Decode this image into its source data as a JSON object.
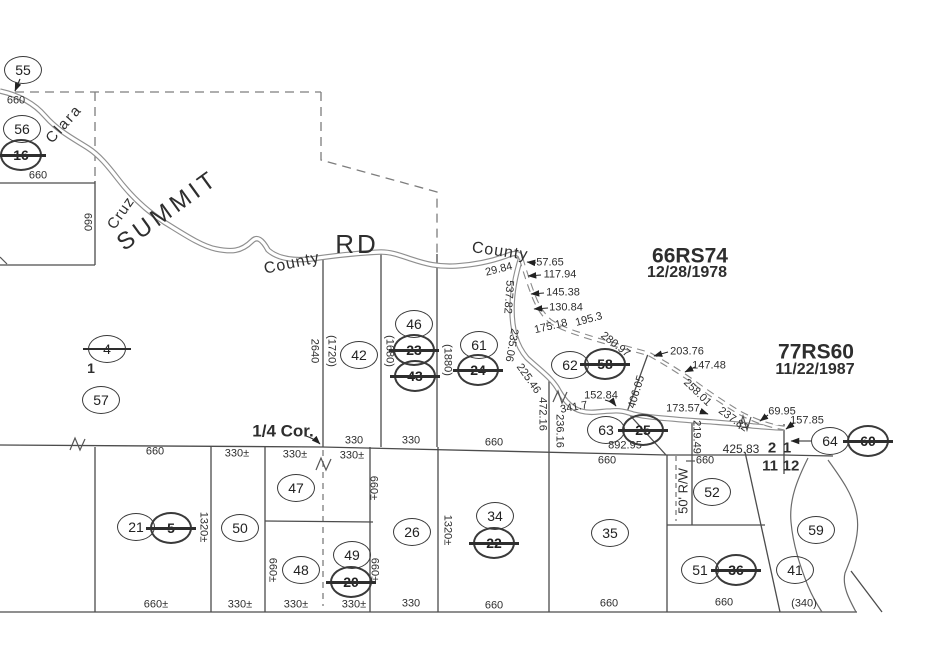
{
  "canvas": {
    "width": 950,
    "height": 650,
    "background": "#ffffff",
    "ink": "#2e2e2e"
  },
  "road": {
    "full_name": "Summit Rd (Santa Clara / Santa Cruz County line)"
  },
  "labels": [
    {
      "t": "Clara",
      "x": 64,
      "y": 124,
      "r": -48,
      "s": 15,
      "ls": 2,
      "k": "road"
    },
    {
      "t": "Cruz",
      "x": 121,
      "y": 213,
      "r": -55,
      "s": 15,
      "ls": 1,
      "k": "road"
    },
    {
      "t": "SUMMIT",
      "x": 168,
      "y": 211,
      "r": -36,
      "s": 24,
      "ls": 4,
      "k": "road"
    },
    {
      "t": "County",
      "x": 292,
      "y": 264,
      "r": -12,
      "s": 16,
      "ls": 1,
      "k": "road"
    },
    {
      "t": "RD",
      "x": 357,
      "y": 244,
      "r": 0,
      "s": 26,
      "ls": 3,
      "k": "road"
    },
    {
      "t": "County",
      "x": 500,
      "y": 252,
      "r": 8,
      "s": 16,
      "ls": 1,
      "k": "road"
    },
    {
      "t": "66RS74",
      "x": 690,
      "y": 256,
      "r": 0,
      "s": 21,
      "k": "survey"
    },
    {
      "t": "12/28/1978",
      "x": 687,
      "y": 273,
      "r": 0,
      "s": 16,
      "k": "survey"
    },
    {
      "t": "77RS60",
      "x": 816,
      "y": 352,
      "r": 0,
      "s": 21,
      "k": "survey"
    },
    {
      "t": "11/22/1987",
      "x": 815,
      "y": 370,
      "r": 0,
      "s": 16,
      "k": "survey"
    },
    {
      "t": "1/4 Cor.",
      "x": 283,
      "y": 431,
      "r": 0,
      "s": 17,
      "k": "corner"
    },
    {
      "t": "1",
      "x": 91,
      "y": 368,
      "r": 0,
      "s": 14,
      "k": "lot"
    },
    {
      "t": "2",
      "x": 772,
      "y": 448,
      "r": 0,
      "s": 15,
      "k": "section"
    },
    {
      "t": "1",
      "x": 787,
      "y": 448,
      "r": 0,
      "s": 15,
      "k": "section"
    },
    {
      "t": "11",
      "x": 770,
      "y": 466,
      "r": 0,
      "s": 15,
      "k": "section"
    },
    {
      "t": "12",
      "x": 791,
      "y": 466,
      "r": 0,
      "s": 15,
      "k": "section"
    },
    {
      "t": "660",
      "x": 16,
      "y": 101
    },
    {
      "t": "660",
      "x": 38,
      "y": 176
    },
    {
      "t": "660",
      "x": 87,
      "y": 222,
      "r": 90
    },
    {
      "t": "29.84",
      "x": 499,
      "y": 270,
      "r": -14
    },
    {
      "t": "57.65",
      "x": 550,
      "y": 263
    },
    {
      "t": "117.94",
      "x": 560,
      "y": 275
    },
    {
      "t": "145.38",
      "x": 563,
      "y": 293
    },
    {
      "t": "130.84",
      "x": 566,
      "y": 308
    },
    {
      "t": "537.82",
      "x": 508,
      "y": 297,
      "r": 94
    },
    {
      "t": "175.18",
      "x": 551,
      "y": 327,
      "r": -13
    },
    {
      "t": "195.3",
      "x": 589,
      "y": 320,
      "r": -15
    },
    {
      "t": "280.97",
      "x": 615,
      "y": 345,
      "r": 38
    },
    {
      "t": "235.06",
      "x": 511,
      "y": 345,
      "r": 100
    },
    {
      "t": "225.46",
      "x": 528,
      "y": 379,
      "r": 55
    },
    {
      "t": "203.76",
      "x": 687,
      "y": 352
    },
    {
      "t": "147.48",
      "x": 709,
      "y": 366
    },
    {
      "t": "258.01",
      "x": 697,
      "y": 393,
      "r": 44
    },
    {
      "t": "237.82",
      "x": 733,
      "y": 420,
      "r": 36
    },
    {
      "t": "406.05",
      "x": 637,
      "y": 392,
      "r": -73
    },
    {
      "t": "152.84",
      "x": 601,
      "y": 396
    },
    {
      "t": "341.7",
      "x": 574,
      "y": 408,
      "r": -10
    },
    {
      "t": "173.57",
      "x": 683,
      "y": 409
    },
    {
      "t": "472.16",
      "x": 542,
      "y": 414,
      "r": 90
    },
    {
      "t": "236.16",
      "x": 559,
      "y": 431,
      "r": 90
    },
    {
      "t": "219.49",
      "x": 696,
      "y": 437,
      "r": 90
    },
    {
      "t": "69.95",
      "x": 782,
      "y": 412
    },
    {
      "t": "157.85",
      "x": 807,
      "y": 421
    },
    {
      "t": "425.83",
      "x": 741,
      "y": 449,
      "s": 12
    },
    {
      "t": "892.95",
      "x": 625,
      "y": 446
    },
    {
      "t": "2640",
      "x": 314,
      "y": 351,
      "r": 90
    },
    {
      "t": "(1720)",
      "x": 331,
      "y": 351,
      "r": 90
    },
    {
      "t": "(1680)",
      "x": 389,
      "y": 351,
      "r": 90
    },
    {
      "t": "(1880)",
      "x": 447,
      "y": 360,
      "r": 90
    },
    {
      "t": "330",
      "x": 354,
      "y": 441
    },
    {
      "t": "330",
      "x": 411,
      "y": 441
    },
    {
      "t": "660",
      "x": 494,
      "y": 443
    },
    {
      "t": "660",
      "x": 155,
      "y": 452
    },
    {
      "t": "330±",
      "x": 237,
      "y": 454
    },
    {
      "t": "330±",
      "x": 295,
      "y": 455
    },
    {
      "t": "330±",
      "x": 352,
      "y": 456
    },
    {
      "t": "660",
      "x": 607,
      "y": 461
    },
    {
      "t": "660",
      "x": 705,
      "y": 461
    },
    {
      "t": "50' R/W",
      "x": 683,
      "y": 491,
      "r": -90,
      "s": 13
    },
    {
      "t": "1320±",
      "x": 203,
      "y": 527,
      "r": 90
    },
    {
      "t": "1320±",
      "x": 447,
      "y": 530,
      "r": 90
    },
    {
      "t": "660±",
      "x": 373,
      "y": 488,
      "r": 90
    },
    {
      "t": "660±",
      "x": 272,
      "y": 570,
      "r": 90
    },
    {
      "t": "660±",
      "x": 374,
      "y": 570,
      "r": 90
    },
    {
      "t": "660±",
      "x": 156,
      "y": 605
    },
    {
      "t": "330±",
      "x": 240,
      "y": 605
    },
    {
      "t": "330±",
      "x": 296,
      "y": 605
    },
    {
      "t": "330±",
      "x": 354,
      "y": 605
    },
    {
      "t": "330",
      "x": 411,
      "y": 604
    },
    {
      "t": "660",
      "x": 494,
      "y": 606
    },
    {
      "t": "660",
      "x": 609,
      "y": 604
    },
    {
      "t": "660",
      "x": 724,
      "y": 603
    },
    {
      "t": "(340)",
      "x": 804,
      "y": 604
    }
  ],
  "parcels": [
    {
      "n": "55",
      "x": 23,
      "y": 70,
      "st": false,
      "hv": false
    },
    {
      "n": "56",
      "x": 22,
      "y": 129,
      "st": false,
      "hv": false
    },
    {
      "n": "16",
      "x": 21,
      "y": 155,
      "st": true,
      "hv": true
    },
    {
      "n": "4",
      "x": 107,
      "y": 349,
      "st": true,
      "hv": false
    },
    {
      "n": "57",
      "x": 101,
      "y": 400,
      "st": false,
      "hv": false
    },
    {
      "n": "42",
      "x": 359,
      "y": 355,
      "st": false,
      "hv": false
    },
    {
      "n": "46",
      "x": 414,
      "y": 324,
      "st": false,
      "hv": false
    },
    {
      "n": "23",
      "x": 414,
      "y": 350,
      "st": true,
      "hv": true
    },
    {
      "n": "43",
      "x": 415,
      "y": 376,
      "st": true,
      "hv": true
    },
    {
      "n": "61",
      "x": 479,
      "y": 345,
      "st": false,
      "hv": false
    },
    {
      "n": "24",
      "x": 478,
      "y": 370,
      "st": true,
      "hv": true
    },
    {
      "n": "62",
      "x": 570,
      "y": 365,
      "st": false,
      "hv": false
    },
    {
      "n": "58",
      "x": 605,
      "y": 364,
      "st": true,
      "hv": true
    },
    {
      "n": "63",
      "x": 606,
      "y": 430,
      "st": false,
      "hv": false
    },
    {
      "n": "25",
      "x": 643,
      "y": 430,
      "st": true,
      "hv": true
    },
    {
      "n": "64",
      "x": 830,
      "y": 441,
      "st": false,
      "hv": false
    },
    {
      "n": "60",
      "x": 868,
      "y": 441,
      "st": true,
      "hv": true
    },
    {
      "n": "47",
      "x": 296,
      "y": 488,
      "st": false,
      "hv": false
    },
    {
      "n": "50",
      "x": 240,
      "y": 528,
      "st": false,
      "hv": false
    },
    {
      "n": "21",
      "x": 136,
      "y": 527,
      "st": false,
      "hv": false
    },
    {
      "n": "5",
      "x": 171,
      "y": 528,
      "st": true,
      "hv": true
    },
    {
      "n": "48",
      "x": 301,
      "y": 570,
      "st": false,
      "hv": false
    },
    {
      "n": "49",
      "x": 352,
      "y": 555,
      "st": false,
      "hv": false
    },
    {
      "n": "20",
      "x": 351,
      "y": 582,
      "st": true,
      "hv": true
    },
    {
      "n": "26",
      "x": 412,
      "y": 532,
      "st": false,
      "hv": false
    },
    {
      "n": "34",
      "x": 495,
      "y": 516,
      "st": false,
      "hv": false
    },
    {
      "n": "22",
      "x": 494,
      "y": 543,
      "st": true,
      "hv": true
    },
    {
      "n": "35",
      "x": 610,
      "y": 533,
      "st": false,
      "hv": false
    },
    {
      "n": "52",
      "x": 712,
      "y": 492,
      "st": false,
      "hv": false
    },
    {
      "n": "51",
      "x": 700,
      "y": 570,
      "st": false,
      "hv": false
    },
    {
      "n": "36",
      "x": 736,
      "y": 570,
      "st": true,
      "hv": true
    },
    {
      "n": "41",
      "x": 795,
      "y": 570,
      "st": false,
      "hv": false
    },
    {
      "n": "59",
      "x": 816,
      "y": 530,
      "st": false,
      "hv": false
    }
  ]
}
